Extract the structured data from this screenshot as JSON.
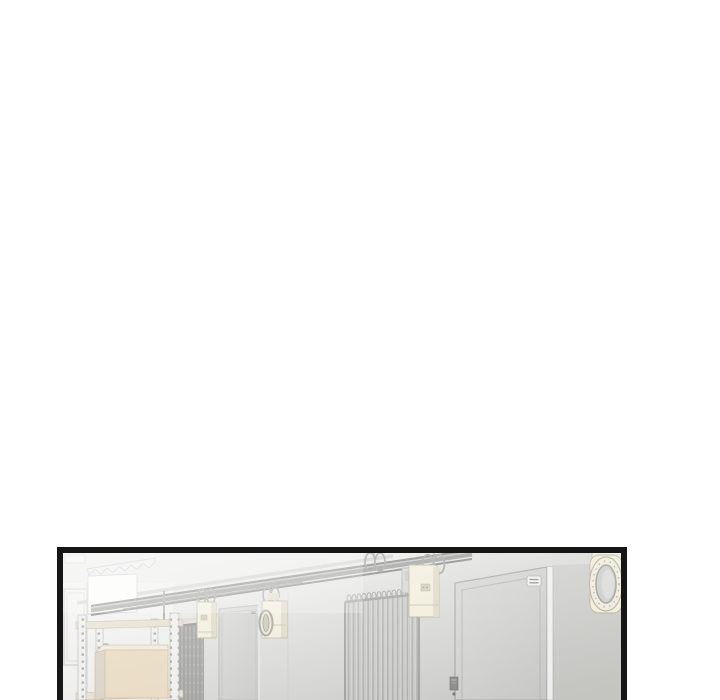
{
  "page": {
    "background": "#ffffff"
  },
  "panel": {
    "style": "black-bordered webtoon panel, faded / washed-out illustration",
    "setting": "warehouse corridor interior with shelving, cardboard box, roller shutter, doors, hanging hoists, pipe bank and porthole fan"
  },
  "scene": {
    "objects": [
      "ceiling-beams",
      "zigzag-trim",
      "white-wall-panel",
      "left-window",
      "shelving-rack",
      "cardboard-box",
      "hook-ring",
      "roller-shutter",
      "small-door",
      "hanging-hoist-small",
      "hanging-hoist-medium",
      "hanging-hoist-large",
      "hanging-rings",
      "pipe-bank",
      "large-door",
      "door-badge",
      "door-keypad",
      "porthole-fan"
    ]
  },
  "colors": {
    "white": "#ffffff",
    "frame": "#161616",
    "wall-light": "#f2f2f1",
    "wall-mid": "#d6d6d4",
    "wall-dark": "#c2c2c0",
    "ceiling": "#e8e8e7",
    "beam-dark": "#7d7d7b",
    "beam-mid": "#959593",
    "beam-light": "#c4c4c2",
    "metal": "#9e9e9c",
    "cream": "#f1edda",
    "cream-shade": "#ddd8c3",
    "cream-edge": "#b6b19b",
    "door-fill": "#d2d2d0",
    "door-line": "#a8a8a6",
    "door-jamb": "#efefed",
    "shutter": "#a5a5a3",
    "shutter-line": "#8d8d8b",
    "tube": "#acacaa",
    "box-front": "#e7d7bd",
    "box-side": "#d7cec0",
    "box-top": "#f1e8d6",
    "box-edge": "#c6b99f",
    "shelf-rail": "#e4ddcc",
    "post": "#ededec",
    "post-line": "#aeaeac",
    "hole": "#a2a2a0",
    "keypad": "#8a8a88",
    "porthole-inner": "#cbcbc9"
  }
}
